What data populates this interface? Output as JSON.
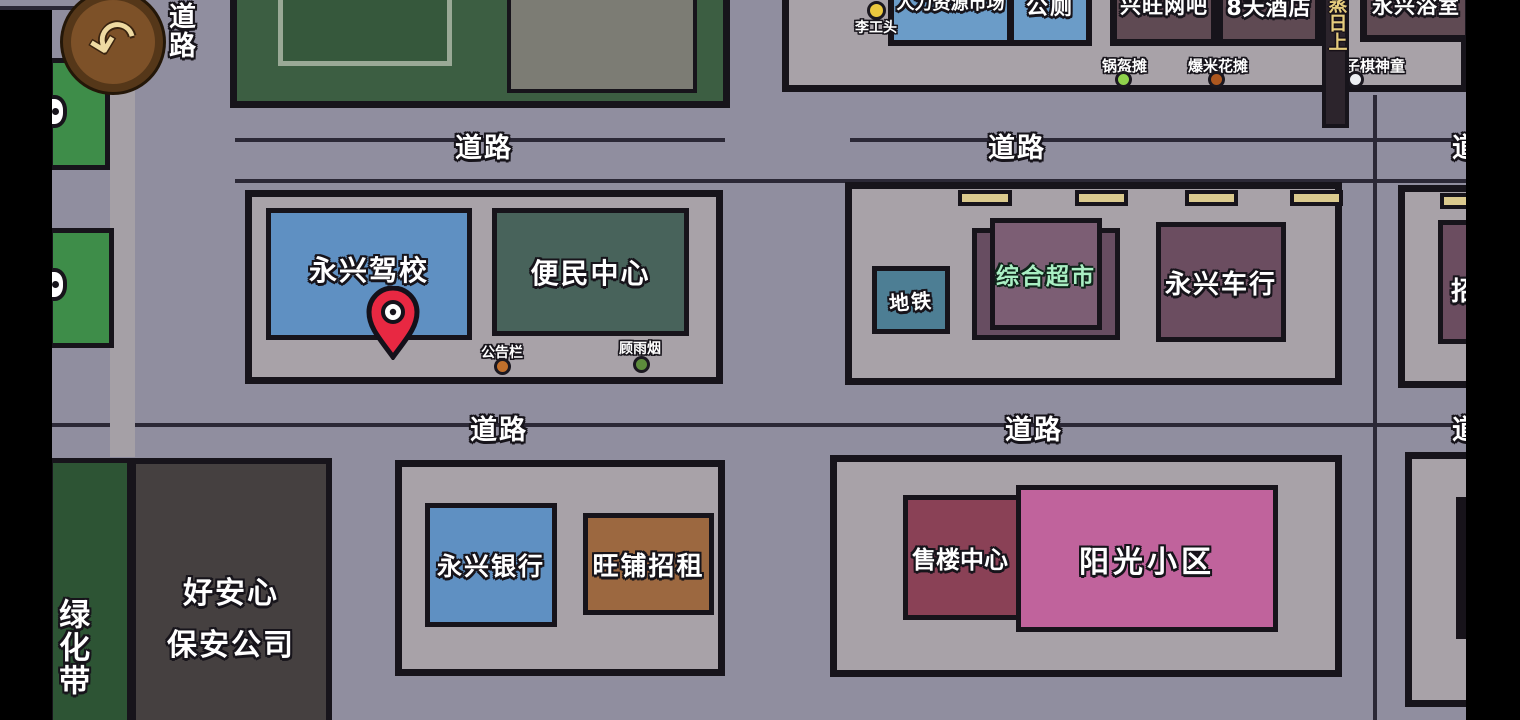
{
  "roads": {
    "label": "道路"
  },
  "colors": {
    "road": "#908e9f",
    "plaza": "#a8a2a8",
    "outline": "#17141b",
    "sidewalk": "#a5a0a6",
    "green_building_top": "#3c5e42",
    "left_green_building": "#3e8d49"
  },
  "top_right": {
    "foreman": {
      "label": "李工头",
      "color": "#ecc93e"
    },
    "hr_market": {
      "label": "人力资源市场",
      "color": "#6b9cc8"
    },
    "toilet": {
      "label": "公厕",
      "color": "#6b9cc8"
    },
    "internet_cafe": {
      "label": "兴旺网吧",
      "color": "#5f4a53"
    },
    "hotel": {
      "label": "8天酒店",
      "color": "#5f4a53"
    },
    "sign": {
      "label": "蒸日上",
      "bg": "#2c242c",
      "text_color": "#e6cc7d"
    },
    "bathhouse": {
      "label": "永兴浴室",
      "color": "#5f4a53"
    },
    "street_stalls": [
      {
        "label": "锅盔摊",
        "color": "#8fd24c"
      },
      {
        "label": "爆米花摊",
        "color": "#ad571f"
      },
      {
        "label": "五子棋神童",
        "color": "#edeff3"
      }
    ]
  },
  "mid": {
    "driving_school": {
      "label": "永兴驾校",
      "color": "#5f90c2"
    },
    "service_center": {
      "label": "便民中心",
      "color": "#48635b"
    },
    "notice_board": {
      "label": "公告栏",
      "color": "#c1702c"
    },
    "gu_yuyan": {
      "label": "顾雨烟",
      "color": "#5d8c3c"
    },
    "subway": {
      "label": "地铁",
      "color": "#4d7e94"
    },
    "supermarket": {
      "label": "综合超市",
      "color": "#7c5e74",
      "back_color": "#674d61",
      "text_color": "#a9efc3"
    },
    "car_dealer": {
      "label": "永兴车行",
      "color": "#6b4d60"
    },
    "partial_shop": {
      "label": "招",
      "color": "#6b4d60"
    },
    "pin_color": "#e82842"
  },
  "bottom": {
    "green_belt": {
      "label": "绿化带",
      "color": "#2d5434"
    },
    "security": {
      "line1": "好安心",
      "line2": "保安公司",
      "color": "#454040"
    },
    "bank": {
      "label": "永兴银行",
      "color": "#5f90c2"
    },
    "shop_rent": {
      "label": "旺铺招租",
      "color": "#9c6840"
    },
    "sales_center": {
      "label": "售楼中心",
      "color": "#8a4156"
    },
    "sunshine": {
      "label": "阳光小区",
      "color": "#c0639c"
    }
  }
}
